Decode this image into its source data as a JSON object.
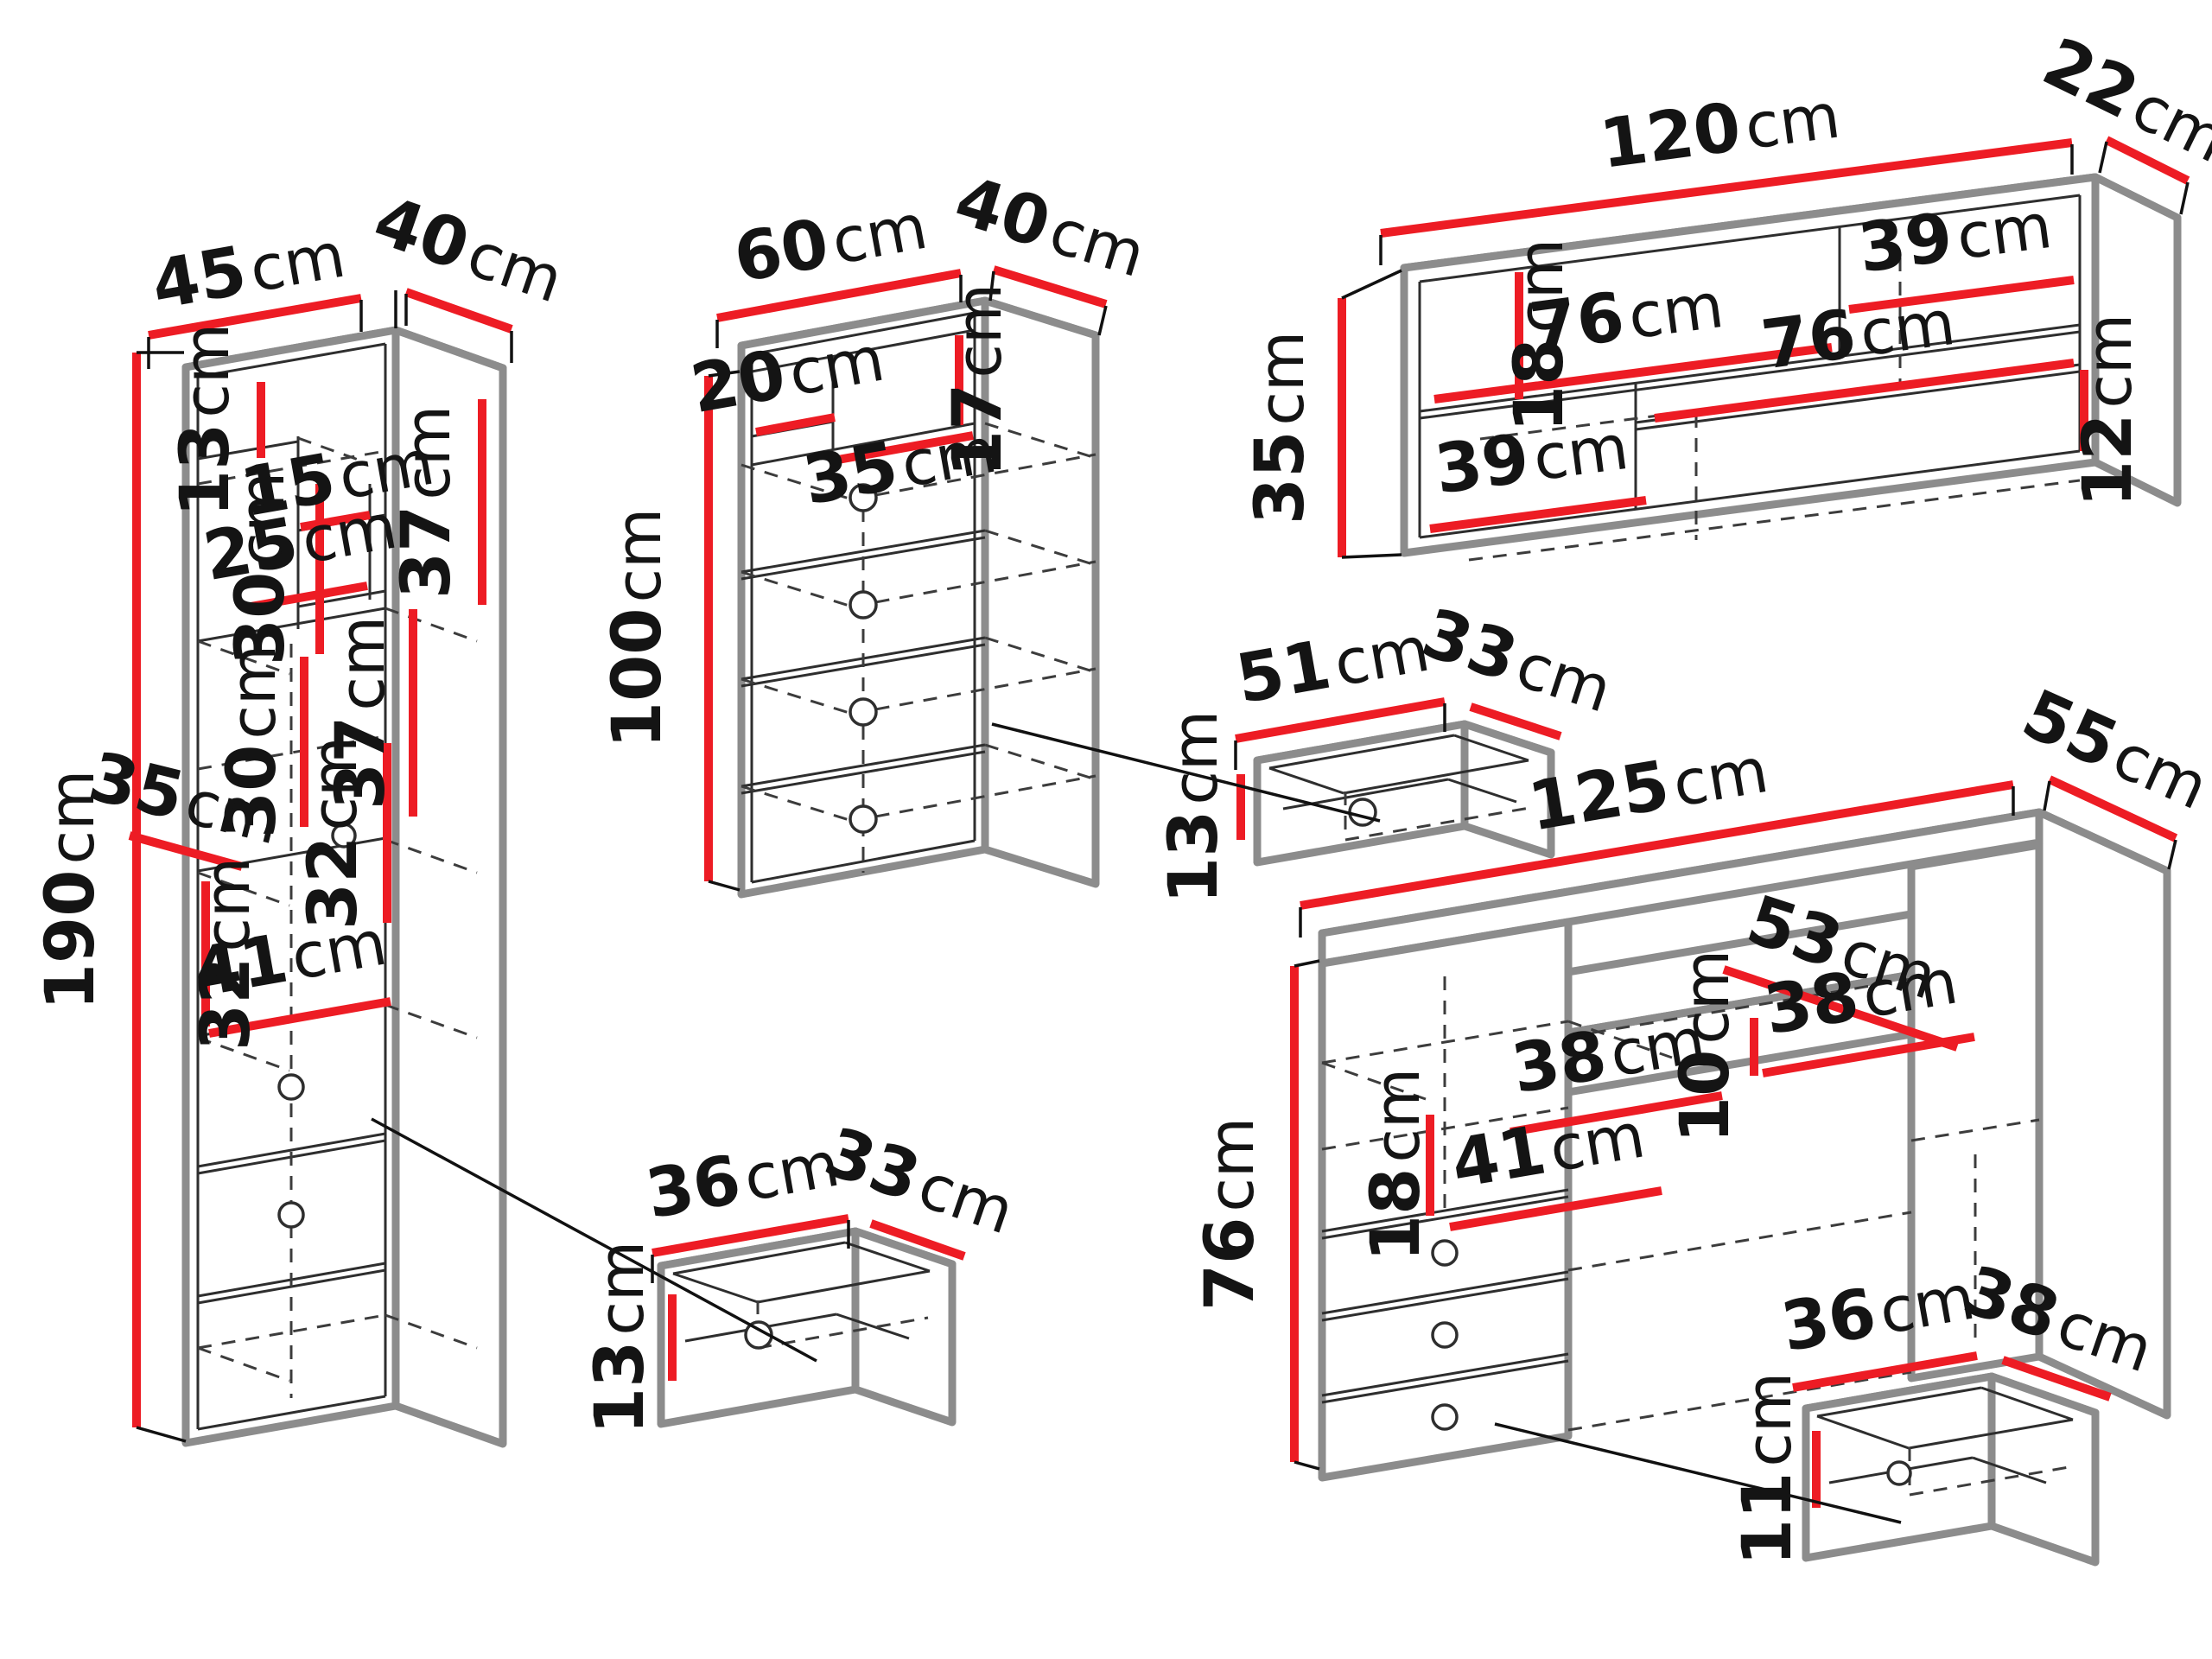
{
  "diagram": {
    "type": "furniture-dimensions",
    "unit": "cm",
    "colors": {
      "dimension_line": "#ed1c24",
      "outline": "#8c8c8c",
      "detail_line": "#2e2e2e",
      "text": "#141414",
      "background": "#ffffff"
    }
  },
  "pieces": {
    "tall_cabinet": {
      "title": "tall shelving cabinet",
      "dims": {
        "width": {
          "value": "45",
          "unit": "cm"
        },
        "depth": {
          "value": "40",
          "unit": "cm"
        },
        "height": {
          "value": "190",
          "unit": "cm"
        },
        "top_shelf_height": {
          "value": "13",
          "unit": "cm"
        },
        "right_top_height": {
          "value": "37",
          "unit": "cm"
        },
        "upper_niche_height": {
          "value": "30",
          "unit": "cm"
        },
        "niche_width": {
          "value": "15",
          "unit": "cm"
        },
        "left_shelf_width": {
          "value": "25",
          "unit": "cm"
        },
        "center_niche_height": {
          "value": "30",
          "unit": "cm"
        },
        "right_mid_height": {
          "value": "37",
          "unit": "cm"
        },
        "upper_section_height": {
          "value": "32",
          "unit": "cm"
        },
        "shelf_depth": {
          "value": "35",
          "unit": "cm"
        },
        "lower_section_height": {
          "value": "32",
          "unit": "cm"
        },
        "bottom_opening_width": {
          "value": "41",
          "unit": "cm"
        }
      }
    },
    "chest": {
      "title": "drawer chest",
      "dims": {
        "width": {
          "value": "60",
          "unit": "cm"
        },
        "depth": {
          "value": "40",
          "unit": "cm"
        },
        "height": {
          "value": "100",
          "unit": "cm"
        },
        "left_niche_width": {
          "value": "20",
          "unit": "cm"
        },
        "right_niche_width": {
          "value": "35",
          "unit": "cm"
        },
        "niche_height": {
          "value": "17",
          "unit": "cm"
        }
      }
    },
    "wall_shelf": {
      "title": "wall shelf unit",
      "dims": {
        "width": {
          "value": "120",
          "unit": "cm"
        },
        "depth": {
          "value": "22",
          "unit": "cm"
        },
        "height": {
          "value": "35",
          "unit": "cm"
        },
        "upper_niche_height": {
          "value": "18",
          "unit": "cm"
        },
        "top_right_width": {
          "value": "39",
          "unit": "cm"
        },
        "middle_shelf_width": {
          "value": "76",
          "unit": "cm"
        },
        "bottom_right_width": {
          "value": "76",
          "unit": "cm"
        },
        "right_slot_height": {
          "value": "12",
          "unit": "cm"
        },
        "bottom_left_width": {
          "value": "39",
          "unit": "cm"
        }
      }
    },
    "chest_drawer": {
      "title": "chest drawer insert",
      "dims": {
        "width": {
          "value": "51",
          "unit": "cm"
        },
        "depth": {
          "value": "33",
          "unit": "cm"
        },
        "height": {
          "value": "13",
          "unit": "cm"
        }
      }
    },
    "cabinet_drawer": {
      "title": "cabinet drawer insert",
      "dims": {
        "width": {
          "value": "36",
          "unit": "cm"
        },
        "depth": {
          "value": "33",
          "unit": "cm"
        },
        "height": {
          "value": "13",
          "unit": "cm"
        }
      }
    },
    "desk": {
      "title": "desk",
      "dims": {
        "width": {
          "value": "125",
          "unit": "cm"
        },
        "depth": {
          "value": "55",
          "unit": "cm"
        },
        "height": {
          "value": "76",
          "unit": "cm"
        },
        "inner_depth": {
          "value": "53",
          "unit": "cm"
        },
        "right_opening_width": {
          "value": "38",
          "unit": "cm"
        },
        "center_drawer_height": {
          "value": "10",
          "unit": "cm"
        },
        "left_opening_width": {
          "value": "38",
          "unit": "cm"
        },
        "pedestal_top_height": {
          "value": "18",
          "unit": "cm"
        },
        "pedestal_width": {
          "value": "41",
          "unit": "cm"
        }
      }
    },
    "desk_drawer": {
      "title": "desk drawer insert",
      "dims": {
        "width": {
          "value": "36",
          "unit": "cm"
        },
        "depth": {
          "value": "38",
          "unit": "cm"
        },
        "height": {
          "value": "11",
          "unit": "cm"
        }
      }
    }
  }
}
